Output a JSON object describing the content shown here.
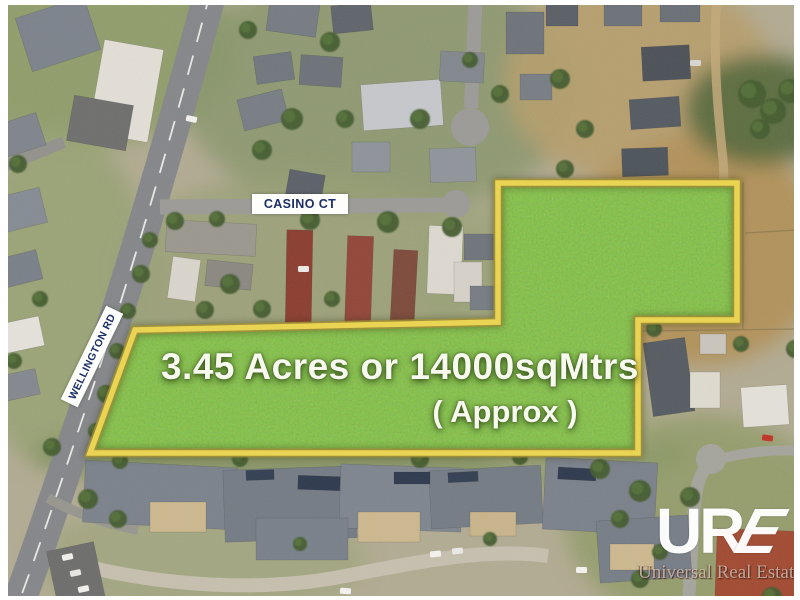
{
  "labels": {
    "casino": "CASINO CT",
    "wellington": "WELLINGTON RD"
  },
  "parcel": {
    "area_line": "3.45 Acres or 14000sqMtrs",
    "approx_line": "( Approx )",
    "fill_color": "#69ae29",
    "border_color": "#ecd54f",
    "border_edge_color": "#9d8c33",
    "points": "498,183 737,183 737,320 638,320 638,453 90,453 135,330 498,322"
  },
  "logo": {
    "mark_ur": "UR",
    "mark_e": "E",
    "name": "Universal Real Estate"
  },
  "scene": {
    "base_color": "#b3ac93",
    "patches": [
      [
        90,
        50,
        150,
        95,
        "#8d9c68",
        0.9
      ],
      [
        60,
        300,
        95,
        170,
        "#99a375",
        0.9
      ],
      [
        380,
        90,
        200,
        125,
        "#8a976d",
        0.85
      ],
      [
        300,
        270,
        185,
        95,
        "#98a077",
        0.8
      ],
      [
        640,
        80,
        135,
        105,
        "#b79e6d",
        0.9
      ],
      [
        700,
        250,
        125,
        115,
        "#b29159",
        0.95
      ],
      [
        760,
        110,
        75,
        55,
        "#55683c",
        0.9
      ],
      [
        360,
        455,
        330,
        42,
        "#80915e",
        0.8
      ],
      [
        700,
        520,
        135,
        105,
        "#8e9b67",
        0.8
      ],
      [
        200,
        560,
        165,
        60,
        "#9aa377",
        0.6
      ],
      [
        480,
        270,
        65,
        65,
        "#9aa377",
        0.7
      ],
      [
        560,
        420,
        95,
        55,
        "#a3a87e",
        0.7
      ]
    ],
    "roads": [
      [
        "M211,-10 C176,120 137,255 96,378 C72,450 42,540 16,610",
        33,
        "#86878a",
        1
      ],
      [
        "M-5,170 L64,142",
        12,
        "#93928c",
        1
      ],
      [
        "M160,207 L449,205",
        15,
        "#9c9b97",
        1
      ],
      [
        "M476,-10 L471,108",
        14,
        "#9c9b97",
        1
      ],
      [
        "M48,498 C80,516 110,524 138,530",
        10,
        "#98978f",
        1
      ],
      [
        "M62,560 C160,588 265,592 345,576 C425,560 490,548 548,556",
        14,
        "#c7c0af",
        1
      ],
      [
        "M688,612 L694,510 C696,485 700,472 711,462",
        13,
        "#a6a59d",
        1
      ],
      [
        "M713,461 C742,452 772,449 806,451",
        10,
        "#a6a59d",
        1
      ],
      [
        "M717,-5 C712,60 719,120 723,160 C726,195 721,225 717,255",
        9,
        "#c3a97a",
        0.85
      ]
    ],
    "bulbs": [
      [
        470,
        127,
        19,
        "#9c9b97"
      ],
      [
        456,
        204,
        14,
        "#9c9b97"
      ],
      [
        711,
        459,
        15,
        "#a6a59d"
      ]
    ],
    "dashes": [
      [
        "M211,-10 C176,120 137,255 96,378 C72,450 42,540 16,610",
        1.8,
        "#f4f4ef",
        "20 14"
      ]
    ],
    "fences": [
      [
        743,
        182,
        743,
        330
      ],
      [
        642,
        331,
        798,
        329
      ],
      [
        745,
        233,
        798,
        230
      ]
    ],
    "buildings": [
      [
        22,
        6,
        72,
        56,
        -18,
        "#7d838c"
      ],
      [
        0,
        118,
        42,
        34,
        -18,
        "#80858d"
      ],
      [
        96,
        44,
        60,
        94,
        10,
        "#e3dfd7"
      ],
      [
        70,
        100,
        60,
        46,
        10,
        "#6f6f6d"
      ],
      [
        0,
        192,
        44,
        36,
        -14,
        "#868c94"
      ],
      [
        0,
        254,
        40,
        30,
        -14,
        "#7b8189"
      ],
      [
        0,
        320,
        42,
        30,
        -12,
        "#e5e2db"
      ],
      [
        2,
        372,
        36,
        26,
        -12,
        "#85898f"
      ],
      [
        268,
        0,
        50,
        34,
        8,
        "#777c83"
      ],
      [
        332,
        4,
        40,
        28,
        -6,
        "#60656c"
      ],
      [
        255,
        54,
        38,
        28,
        -8,
        "#72777e"
      ],
      [
        300,
        56,
        42,
        30,
        4,
        "#6e737a"
      ],
      [
        240,
        94,
        46,
        32,
        -14,
        "#797e85"
      ],
      [
        362,
        82,
        80,
        46,
        -4,
        "#c6c8cb"
      ],
      [
        286,
        172,
        36,
        42,
        10,
        "#5c6169"
      ],
      [
        352,
        142,
        38,
        30,
        0,
        "#8f949a"
      ],
      [
        430,
        148,
        46,
        34,
        -2,
        "#90959b"
      ],
      [
        440,
        52,
        44,
        30,
        3,
        "#83888f"
      ],
      [
        506,
        12,
        38,
        42,
        0,
        "#6f747b"
      ],
      [
        520,
        74,
        32,
        26,
        0,
        "#797e85"
      ],
      [
        546,
        2,
        32,
        24,
        0,
        "#5b6067"
      ],
      [
        604,
        0,
        38,
        26,
        0,
        "#6d7279"
      ],
      [
        660,
        0,
        40,
        22,
        0,
        "#6b7077"
      ],
      [
        642,
        46,
        48,
        34,
        -3,
        "#4d5258"
      ],
      [
        630,
        98,
        50,
        30,
        -4,
        "#555b62"
      ],
      [
        622,
        148,
        46,
        28,
        -2,
        "#4f555c"
      ],
      [
        166,
        222,
        90,
        32,
        3,
        "#9b988f"
      ],
      [
        170,
        258,
        28,
        42,
        8,
        "#dad6cd"
      ],
      [
        206,
        262,
        46,
        26,
        6,
        "#8c8882"
      ],
      [
        286,
        230,
        26,
        100,
        1,
        "#8c3e31"
      ],
      [
        346,
        236,
        26,
        94,
        2,
        "#93473a"
      ],
      [
        392,
        250,
        24,
        72,
        3,
        "#7e4b3c"
      ],
      [
        428,
        226,
        34,
        68,
        2,
        "#ddd9d0"
      ],
      [
        454,
        262,
        28,
        40,
        0,
        "#d6d2c9"
      ],
      [
        464,
        234,
        30,
        26,
        0,
        "#70757c"
      ],
      [
        470,
        286,
        26,
        24,
        0,
        "#787d84"
      ],
      [
        648,
        340,
        42,
        74,
        -8,
        "#575c63"
      ],
      [
        690,
        372,
        30,
        36,
        0,
        "#dfdbcf"
      ],
      [
        742,
        386,
        46,
        40,
        -4,
        "#e4e1d9"
      ],
      [
        700,
        334,
        26,
        20,
        0,
        "#cac6bd"
      ],
      [
        84,
        464,
        152,
        62,
        3,
        "#7c838c"
      ],
      [
        224,
        468,
        132,
        72,
        -2,
        "#757c85"
      ],
      [
        340,
        466,
        122,
        64,
        2,
        "#7f868f"
      ],
      [
        256,
        518,
        92,
        42,
        0,
        "#79818b"
      ],
      [
        430,
        468,
        112,
        58,
        -3,
        "#757c85"
      ],
      [
        544,
        460,
        112,
        72,
        3,
        "#7b828b"
      ],
      [
        598,
        518,
        92,
        62,
        -4,
        "#777e87"
      ],
      [
        716,
        530,
        86,
        72,
        2,
        "#a34b33"
      ],
      [
        150,
        502,
        56,
        30,
        0,
        "#cdb98f"
      ],
      [
        358,
        512,
        62,
        30,
        0,
        "#cdb98f"
      ],
      [
        470,
        512,
        46,
        24,
        0,
        "#c9b58b"
      ],
      [
        610,
        544,
        44,
        26,
        0,
        "#cdb98f"
      ],
      [
        298,
        476,
        42,
        14,
        2,
        "#2e3a4e"
      ],
      [
        394,
        472,
        36,
        12,
        0,
        "#2e3a4e"
      ],
      [
        558,
        468,
        38,
        12,
        3,
        "#2e3a4e"
      ],
      [
        246,
        470,
        28,
        10,
        -2,
        "#333f53"
      ],
      [
        448,
        472,
        30,
        10,
        -3,
        "#333f53"
      ],
      [
        52,
        546,
        48,
        58,
        -12,
        "#6e6e6c"
      ]
    ],
    "trees": [
      [
        175,
        221,
        9
      ],
      [
        217,
        219,
        8
      ],
      [
        310,
        220,
        10
      ],
      [
        388,
        222,
        11
      ],
      [
        452,
        227,
        10
      ],
      [
        520,
        229,
        12
      ],
      [
        556,
        241,
        10
      ],
      [
        150,
        240,
        8
      ],
      [
        141,
        274,
        9
      ],
      [
        128,
        311,
        8
      ],
      [
        117,
        351,
        8
      ],
      [
        106,
        394,
        9
      ],
      [
        96,
        431,
        8
      ],
      [
        18,
        164,
        9
      ],
      [
        40,
        299,
        8
      ],
      [
        14,
        361,
        8
      ],
      [
        52,
        447,
        9
      ],
      [
        88,
        499,
        10
      ],
      [
        118,
        519,
        9
      ],
      [
        248,
        30,
        9
      ],
      [
        330,
        42,
        10
      ],
      [
        292,
        119,
        11
      ],
      [
        345,
        119,
        9
      ],
      [
        262,
        150,
        10
      ],
      [
        420,
        119,
        10
      ],
      [
        500,
        94,
        9
      ],
      [
        470,
        60,
        8
      ],
      [
        560,
        79,
        10
      ],
      [
        585,
        129,
        9
      ],
      [
        610,
        189,
        8
      ],
      [
        565,
        169,
        9
      ],
      [
        752,
        94,
        14
      ],
      [
        773,
        111,
        13
      ],
      [
        790,
        91,
        12
      ],
      [
        760,
        129,
        10
      ],
      [
        654,
        329,
        8
      ],
      [
        741,
        344,
        8
      ],
      [
        795,
        349,
        9
      ],
      [
        120,
        461,
        8
      ],
      [
        240,
        459,
        8
      ],
      [
        420,
        459,
        9
      ],
      [
        520,
        457,
        8
      ],
      [
        600,
        469,
        10
      ],
      [
        640,
        491,
        11
      ],
      [
        690,
        497,
        10
      ],
      [
        620,
        519,
        9
      ],
      [
        640,
        579,
        9
      ],
      [
        772,
        597,
        10
      ],
      [
        230,
        284,
        10
      ],
      [
        262,
        309,
        9
      ],
      [
        332,
        299,
        8
      ],
      [
        205,
        310,
        9
      ],
      [
        300,
        544,
        7
      ],
      [
        490,
        539,
        7
      ],
      [
        660,
        552,
        8
      ]
    ],
    "cars": [
      [
        62,
        554,
        -12,
        "#f2f1ed"
      ],
      [
        70,
        570,
        -12,
        "#e8e7e3"
      ],
      [
        78,
        586,
        -12,
        "#f2f1ed"
      ],
      [
        430,
        551,
        -6,
        "#f4f3ef"
      ],
      [
        452,
        548,
        -6,
        "#eceae6"
      ],
      [
        576,
        567,
        0,
        "#f4f3ef"
      ],
      [
        340,
        588,
        3,
        "#f4f3ef"
      ],
      [
        762,
        435,
        8,
        "#c03527"
      ],
      [
        298,
        266,
        0,
        "#eceae6"
      ],
      [
        186,
        116,
        12,
        "#f2f1ed"
      ],
      [
        690,
        60,
        0,
        "#d8d6d2"
      ]
    ]
  }
}
